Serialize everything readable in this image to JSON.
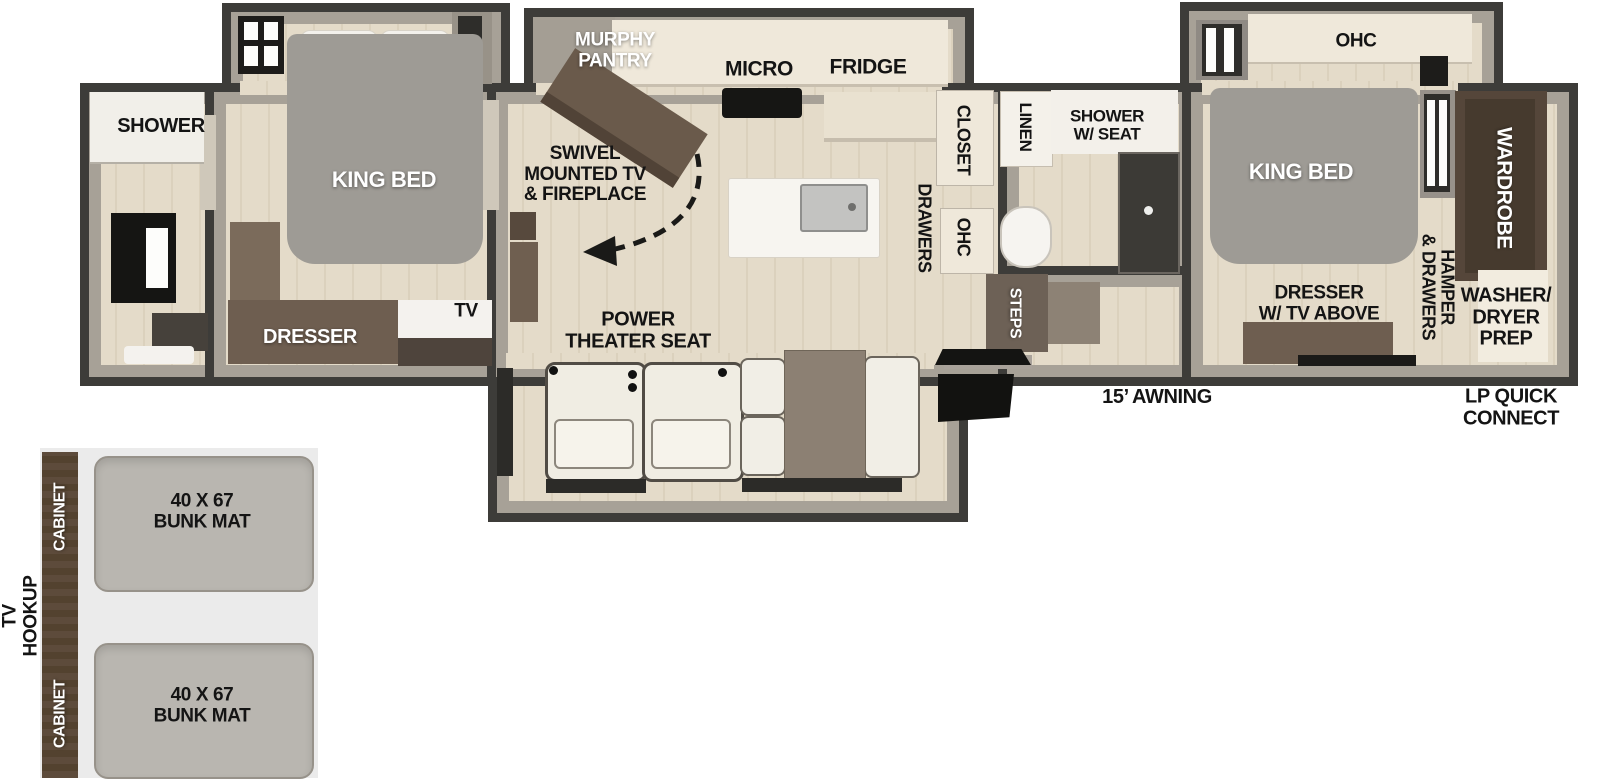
{
  "title": "Travel trailer floor plan",
  "sections": {
    "rear_bath": {
      "shower": "SHOWER"
    },
    "rear_bedroom": {
      "king_bed": "KING BED",
      "dresser": "DRESSER",
      "tv": "TV"
    },
    "kitchen_living": {
      "murphy_pantry": [
        "MURPHY",
        "PANTRY"
      ],
      "micro": "MICRO",
      "fridge": "FRIDGE",
      "swivel": [
        "SWIVEL",
        "MOUNTED TV",
        "& FIREPLACE"
      ],
      "closet": "CLOSET",
      "drawers": "DRAWERS",
      "ohc": "OHC",
      "power_theater": [
        "POWER",
        "THEATER SEAT"
      ]
    },
    "mid_bath": {
      "linen": "LINEN",
      "shower_w_seat": [
        "SHOWER",
        "W/ SEAT"
      ],
      "steps": "STEPS"
    },
    "front_bedroom": {
      "ohc": "OHC",
      "king_bed": "KING BED",
      "dresser_tv_above": [
        "DRESSER",
        "W/ TV ABOVE"
      ],
      "hamper_drawers": [
        "HAMPER",
        "& DRAWERS"
      ],
      "wardrobe": "WARDROBE",
      "washer_dryer_prep": [
        "WASHER/",
        "DRYER",
        "PREP"
      ]
    },
    "exterior": {
      "awning": "15’ AWNING",
      "lp_quick_connect": [
        "LP QUICK",
        "CONNECT"
      ]
    },
    "bunk_room": {
      "tv_hookup": [
        "TV",
        "HOOKUP"
      ],
      "cabinet_top": "CABINET",
      "cabinet_bottom": "CABINET",
      "bunk_mat_top": [
        "40 X 67",
        "BUNK MAT"
      ],
      "bunk_mat_bottom": [
        "40 X 67",
        "BUNK MAT"
      ]
    }
  },
  "colors": {
    "wall": "#3d3c39",
    "wall_face": "#a7a197",
    "floor": "#e4dbc9",
    "counter_cream": "#efe8da",
    "furniture_brown": "#6e5e50",
    "dark_brown": "#55463a",
    "bed_gray": "#9e9b95",
    "mat_gray": "#b9b6b0",
    "seat_white": "#f0ede3",
    "inset_bg": "#ebebeb",
    "black": "#141412"
  }
}
